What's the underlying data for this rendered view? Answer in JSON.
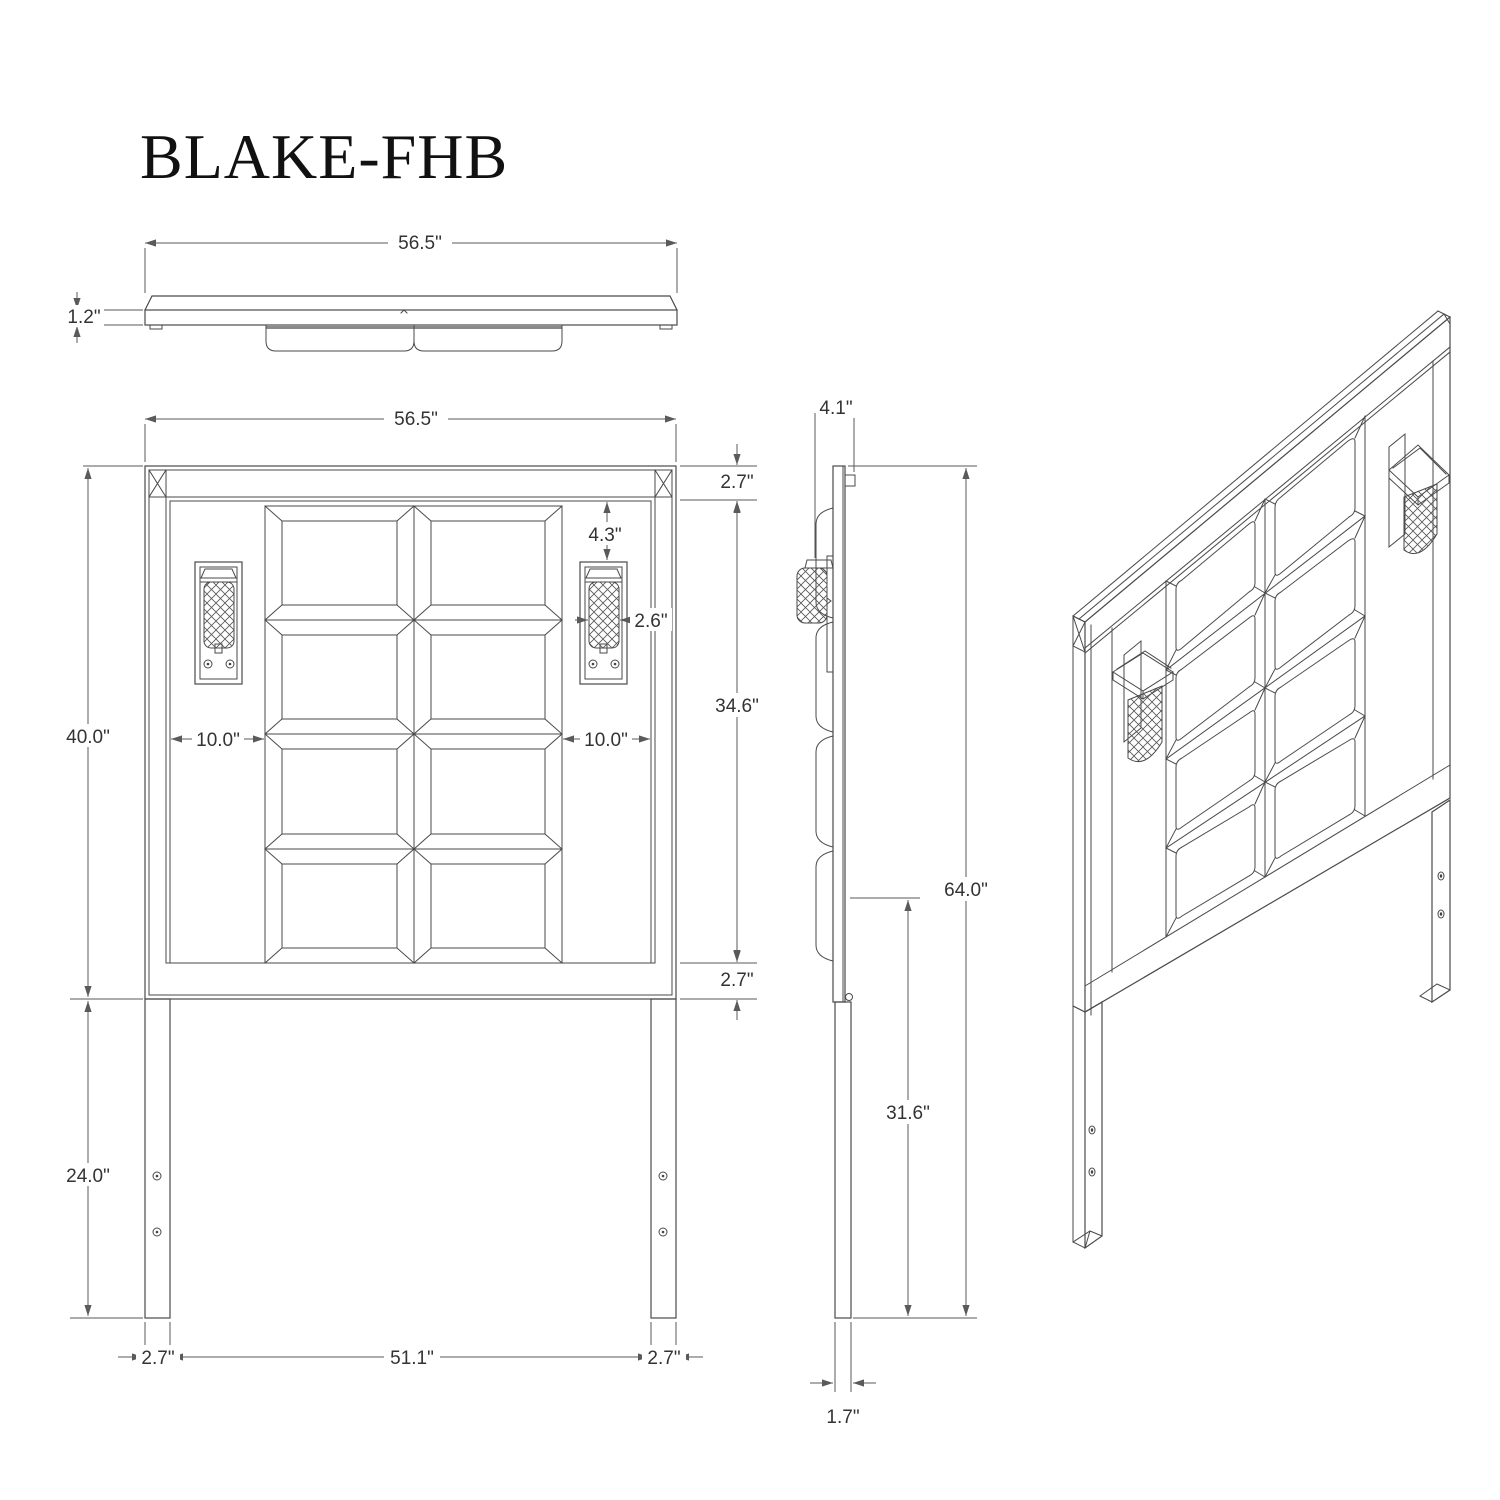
{
  "title": "BLAKE-FHB",
  "accent_colors": {
    "line": "#4a4a4a",
    "dimension": "#5a5a5a",
    "background": "#ffffff"
  },
  "views": {
    "top": {
      "width_label": "56.5\"",
      "thickness_label": "1.2\""
    },
    "front": {
      "width_label": "56.5\"",
      "top_rail_label": "2.7\"",
      "sconce_drop_label": "4.3\"",
      "sconce_width_label": "2.6\"",
      "gap_left_label": "10.0\"",
      "gap_right_label": "10.0\"",
      "inner_height_label": "34.6\"",
      "panel_height_label": "40.0\"",
      "bottom_rail_label": "2.7\"",
      "leg_length_label": "24.0\"",
      "bottom_margin_left_label": "2.7\"",
      "bottom_span_label": "51.1\"",
      "bottom_margin_right_label": "2.7\""
    },
    "side": {
      "depth_label": "4.1\"",
      "total_height_label": "64.0\"",
      "rail_height_label": "31.6\"",
      "leg_thickness_label": "1.7\""
    }
  }
}
